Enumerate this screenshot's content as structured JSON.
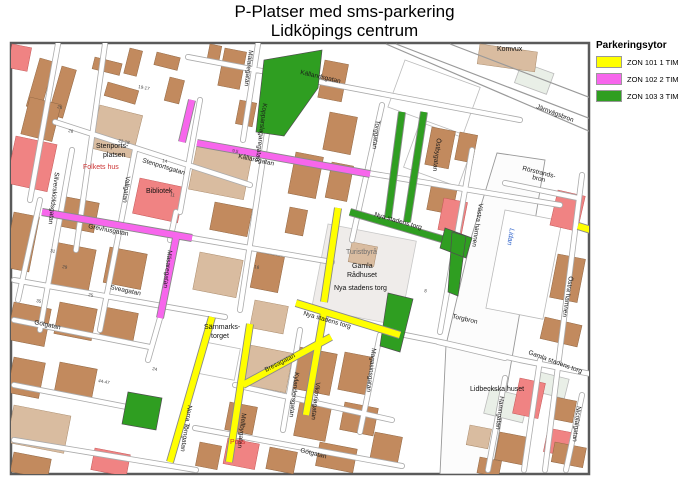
{
  "title": {
    "line1": "P-Platser med sms-parkering",
    "line2": "Lidköpings centrum"
  },
  "legend": {
    "title": "Parkeringsytor",
    "items": [
      {
        "zone": "ZON 101 1 TIM",
        "color": "#FFFF00"
      },
      {
        "zone": "ZON 102 2 TIM",
        "color": "#F766EC"
      },
      {
        "zone": "ZON 103 3 TIM",
        "color": "#2F9E21"
      }
    ]
  },
  "map": {
    "streets": {
      "kallandsgatan": "Källandsgatan",
      "kallaregatan": "Kållaregatan",
      "grevhusgatan": "Grevhusgatan",
      "masaregatan": "Mäsaregatan",
      "kopparslagaregatan": "Kopparslagaregatan",
      "malaregatan": "Mälaregatan",
      "torggatan": "Torggatan",
      "ostbygatan": "Östbygatan",
      "stenportsgatan": "Stenportsgatan",
      "silverskioldsgatan": "Silverskiöldsgatan",
      "vallgatan": "Vallgatan",
      "sveagatan": "Sveagatan",
      "gotgatan": "Götgatan",
      "norra_torngatan": "Norra Torngatan",
      "mellbygatan": "Mellbygatan",
      "kylandersgatan": "Kylandersgatan",
      "viktoriagatan": "Viktoriagatan",
      "magasinsgatan": "Magasinsgatan",
      "bresagatan": "Bresagatan",
      "hamngatan": "Hamngatan",
      "nicolaigatan": "Nicolaigatan",
      "vastra_hamnen": "Västra hamnen",
      "ostra_hamnen": "Östra hamnen",
      "nya_stadens_torg_street": "Nya stadens torg"
    },
    "places": {
      "komvux": "Komvux",
      "stenportsplatsen_l1": "Stenports-",
      "stenportsplatsen_l2": "platsen",
      "folkets_hus": "Folkets hus",
      "bibliotek": "Bibliotek",
      "turistbyra": "Turistbyrå",
      "gamla_radhuset_l1": "Gamla",
      "gamla_radhuset_l2": "Rådhuset",
      "nya_stadens_torg": "Nya stadens torg",
      "sarnmarkstorget_l1": "Särnmarks-",
      "sarnmarkstorget_l2": "torget",
      "gamla_stadens_torg": "Gamla stadens torg",
      "lidbeckska_huset": "Lidbeckska huset",
      "polis": "Polis"
    },
    "bridges": {
      "jarnvagsbron": "Järnvägsbron",
      "rorstrandsbron_l1": "Rörstrands-",
      "rorstrandsbron_l2": "bron",
      "torgbron": "Torgbron"
    },
    "water": {
      "river": "Lidan"
    },
    "address_numbers": [
      "28",
      "26",
      "19-17",
      "22-18",
      "14",
      "11",
      "31",
      "29",
      "35",
      "25",
      "44-47",
      "24",
      "9,5",
      "16",
      "23",
      "8"
    ]
  }
}
